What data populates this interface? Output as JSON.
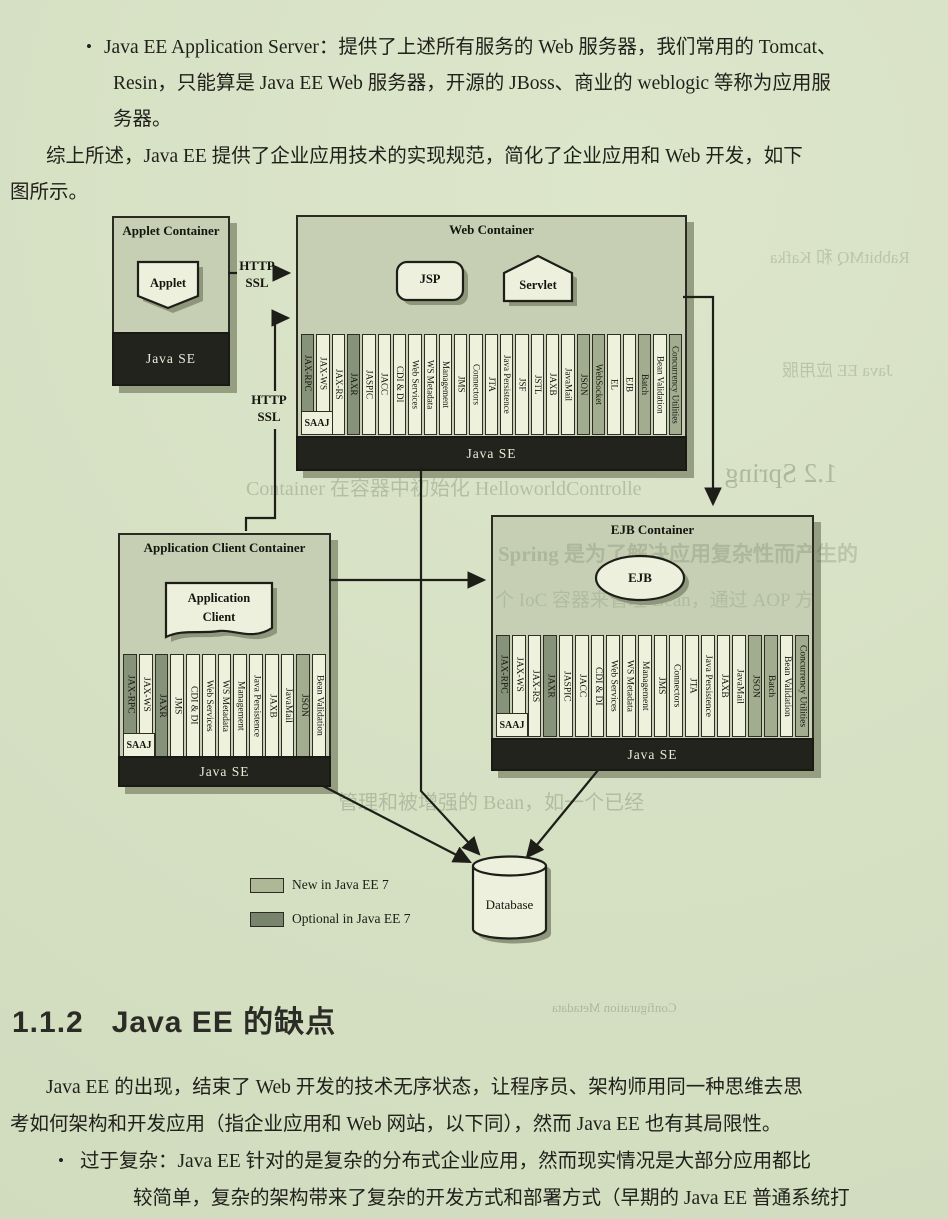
{
  "intro": {
    "bullet_marker": "•",
    "line1": "Java EE Application Server：提供了上述所有服务的 Web 服务器，我们常用的 Tomcat、",
    "line2": "Resin，只能算是 Java EE Web 服务器，开源的 JBoss、商业的 weblogic 等称为应用服",
    "line3": "务器。",
    "line4": "综上所述，Java EE 提供了企业应用技术的实现规范，简化了企业应用和 Web 开发，如下",
    "line5": "图所示。"
  },
  "diagram": {
    "applet_container": {
      "title": "Applet Container",
      "component": "Applet",
      "platform": "Java SE"
    },
    "web_container": {
      "title": "Web Container",
      "component_jsp": "JSP",
      "component_servlet": "Servlet",
      "platform": "Java SE",
      "saaj": "SAAJ",
      "apis": [
        {
          "label": "JAX-RPC",
          "type": "optional",
          "size": "short"
        },
        {
          "label": "JAX-WS",
          "size": "short"
        },
        {
          "label": "JAX-RS"
        },
        {
          "label": "JAXR",
          "type": "optional"
        },
        {
          "label": "JASPIC"
        },
        {
          "label": "JACC"
        },
        {
          "label": "CDI & DI"
        },
        {
          "label": "Web Services"
        },
        {
          "label": "WS Metadata"
        },
        {
          "label": "Management"
        },
        {
          "label": "JMS"
        },
        {
          "label": "Connectors"
        },
        {
          "label": "JTA"
        },
        {
          "label": "Java Persistence"
        },
        {
          "label": "JSF"
        },
        {
          "label": "JSTL"
        },
        {
          "label": "JAXB"
        },
        {
          "label": "JavaMail"
        },
        {
          "label": "JSON",
          "type": "new"
        },
        {
          "label": "WebSocket",
          "type": "new"
        },
        {
          "label": "EL"
        },
        {
          "label": "EJB"
        },
        {
          "label": "Batch",
          "type": "new"
        },
        {
          "label": "Bean Validation"
        },
        {
          "label": "Concurrency Utilities",
          "type": "new"
        }
      ]
    },
    "app_client_container": {
      "title": "Application Client Container",
      "component_line1": "Application",
      "component_line2": "Client",
      "platform": "Java SE",
      "saaj": "SAAJ",
      "apis": [
        {
          "label": "JAX-RPC",
          "type": "optional",
          "size": "short"
        },
        {
          "label": "JAX-WS",
          "size": "short"
        },
        {
          "label": "JAXR",
          "type": "optional"
        },
        {
          "label": "JMS"
        },
        {
          "label": "CDI & DI"
        },
        {
          "label": "Web Services"
        },
        {
          "label": "WS Metadata"
        },
        {
          "label": "Management"
        },
        {
          "label": "Java Persistence"
        },
        {
          "label": "JAXB"
        },
        {
          "label": "JavaMail"
        },
        {
          "label": "JSON",
          "type": "new"
        },
        {
          "label": "Bean Validation"
        }
      ]
    },
    "ejb_container": {
      "title": "EJB Container",
      "component": "EJB",
      "platform": "Java SE",
      "saaj": "SAAJ",
      "apis": [
        {
          "label": "JAX-RPC",
          "type": "optional",
          "size": "short"
        },
        {
          "label": "JAX-WS",
          "size": "short"
        },
        {
          "label": "JAX-RS"
        },
        {
          "label": "JAXR",
          "type": "optional"
        },
        {
          "label": "JASPIC"
        },
        {
          "label": "JACC"
        },
        {
          "label": "CDI & DI"
        },
        {
          "label": "Web Services"
        },
        {
          "label": "WS Metadata"
        },
        {
          "label": "Management"
        },
        {
          "label": "JMS"
        },
        {
          "label": "Connectors"
        },
        {
          "label": "JTA"
        },
        {
          "label": "Java Persistence"
        },
        {
          "label": "JAXB"
        },
        {
          "label": "JavaMail"
        },
        {
          "label": "JSON",
          "type": "new"
        },
        {
          "label": "Batch",
          "type": "new"
        },
        {
          "label": "Bean Validation"
        },
        {
          "label": "Concurrency Utilities",
          "type": "new"
        }
      ]
    },
    "http_ssl_1": {
      "line1": "HTTP",
      "line2": "SSL"
    },
    "http_ssl_2": {
      "line1": "HTTP",
      "line2": "SSL"
    },
    "database": "Database",
    "legend": [
      {
        "label": "New in Java EE 7",
        "type": "new"
      },
      {
        "label": "Optional in Java EE 7",
        "type": "optional"
      }
    ]
  },
  "section": {
    "number": "1.1.2",
    "title": "Java EE 的缺点",
    "para_line1": "Java EE 的出现，结束了 Web 开发的技术无序状态，让程序员、架构师用同一种思维去思",
    "para_line2": "考如何架构和开发应用（指企业应用和 Web 网站，以下同），然而 Java EE 也有其局限性。",
    "bullet_marker": "•",
    "bullet_line1": "过于复杂：Java EE 针对的是复杂的分布式企业应用，然而现实情况是大部分应用都比",
    "bullet_line2": "较简单，复杂的架构带来了复杂的开发方式和部署方式（早期的 Java EE 普通系统打"
  },
  "ghosts": {
    "g1": "Container 在容器中初始化 HelloworldControlle",
    "g2": "Spring 是为了解决应用复杂性而产生的",
    "g3": "个 IoC 容器来管理 Bean，通过 AOP 方",
    "g4": "1.2  Spring",
    "g5": "RabbitMQ 和 Kafka",
    "g6": "Java EE 应用服",
    "g7": "管理和被增强的 Bean，如一个已经",
    "g8": "Configuration Metadata"
  },
  "colors": {
    "paper": "#d6e0c3",
    "container_fill": "#c6cfb3",
    "bar_standard": "#eef1dc",
    "bar_new": "#a2ac8e",
    "bar_optional": "#87927a",
    "java_se_bar": "#23231e",
    "ink": "#20211b"
  }
}
